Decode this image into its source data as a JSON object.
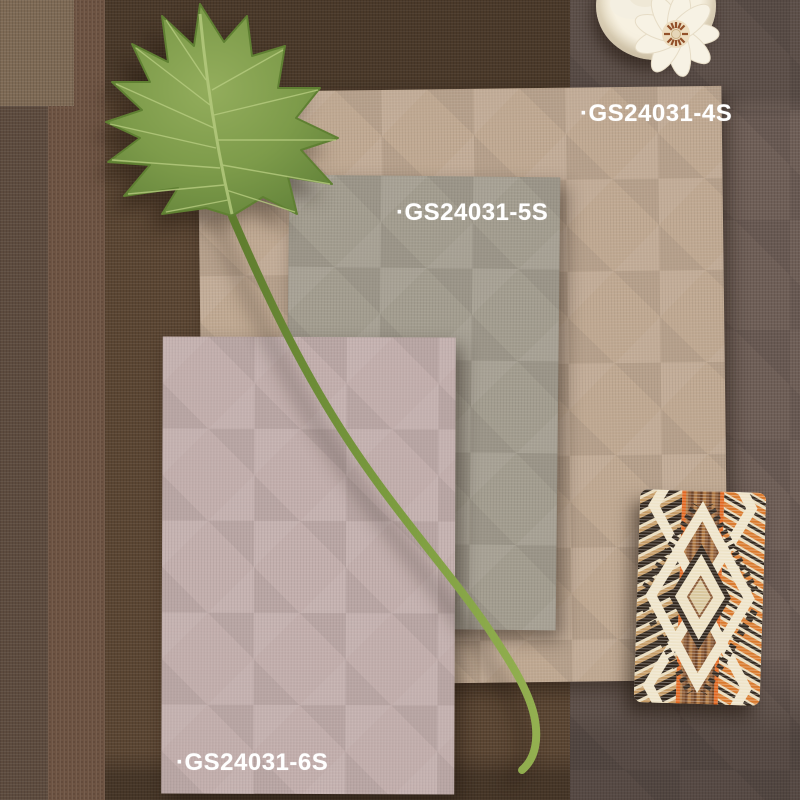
{
  "labels": {
    "swatch_4s": "·GS24031-4S",
    "swatch_5s": "·GS24031-5S",
    "swatch_6s": "·GS24031-6S"
  },
  "colors": {
    "swatch_4s": "#c0a992",
    "swatch_5s": "#a39d8f",
    "swatch_6s": "#c3afad",
    "background_base_brown": "#5a4532",
    "background_left_strip": "#5d4b3e",
    "background_left_strip_2": "#6e5443",
    "background_top_left_patch": "#7e6a55",
    "background_right_panel": "#6f5f57",
    "label_text": "#ffffff",
    "leaf_green": "#7d9b4a",
    "stem_green": "#7a9a3e",
    "card_cream": "#e8dabb",
    "card_orange": "#e0661f",
    "card_dark": "#32271d",
    "card_brown": "#8a5a36",
    "plate_cream": "#f1ead8",
    "flower_white": "#f7f2e4",
    "flower_stamen": "#93512a"
  }
}
